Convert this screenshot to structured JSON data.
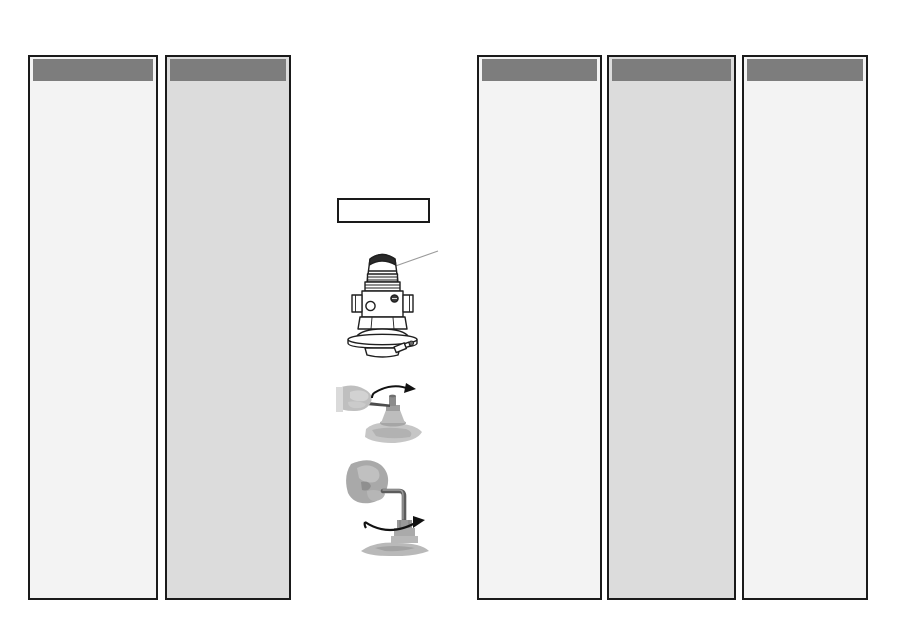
{
  "page": {
    "kind": "scanned manual page",
    "background": "#ffffff"
  },
  "colors": {
    "page-bg": "#ffffff",
    "column-border": "#1a1a1a",
    "header-bar": "#7d7d7d",
    "column-light": "#f3f3f3",
    "column-shaded": "#dcdcdc",
    "line-art": "#1f1f1f",
    "leader-line": "#9a9a9a",
    "photo-gray": "#b5b5b5",
    "arrow": "#111111"
  },
  "columns": [
    {
      "id": "column-1",
      "shade": "light",
      "header_text": "",
      "body_text": ""
    },
    {
      "id": "column-2",
      "shade": "shaded",
      "header_text": "",
      "body_text": ""
    },
    {
      "id": "column-3",
      "shade": "light",
      "header_text": "",
      "body_text": ""
    },
    {
      "id": "column-4",
      "shade": "shaded",
      "header_text": "",
      "body_text": ""
    },
    {
      "id": "column-5",
      "shade": "light",
      "header_text": "",
      "body_text": ""
    }
  ],
  "figures": {
    "callout_box_text": "",
    "valve_diagram": "valve-line-drawing-with-leader-line-to-cap",
    "photo_top": "hand-turning-valve-stem-with-flat-tool-rotation-arrow",
    "photo_bottom": "hand-turning-valve-stem-with-hex-key-rotation-arrow"
  }
}
